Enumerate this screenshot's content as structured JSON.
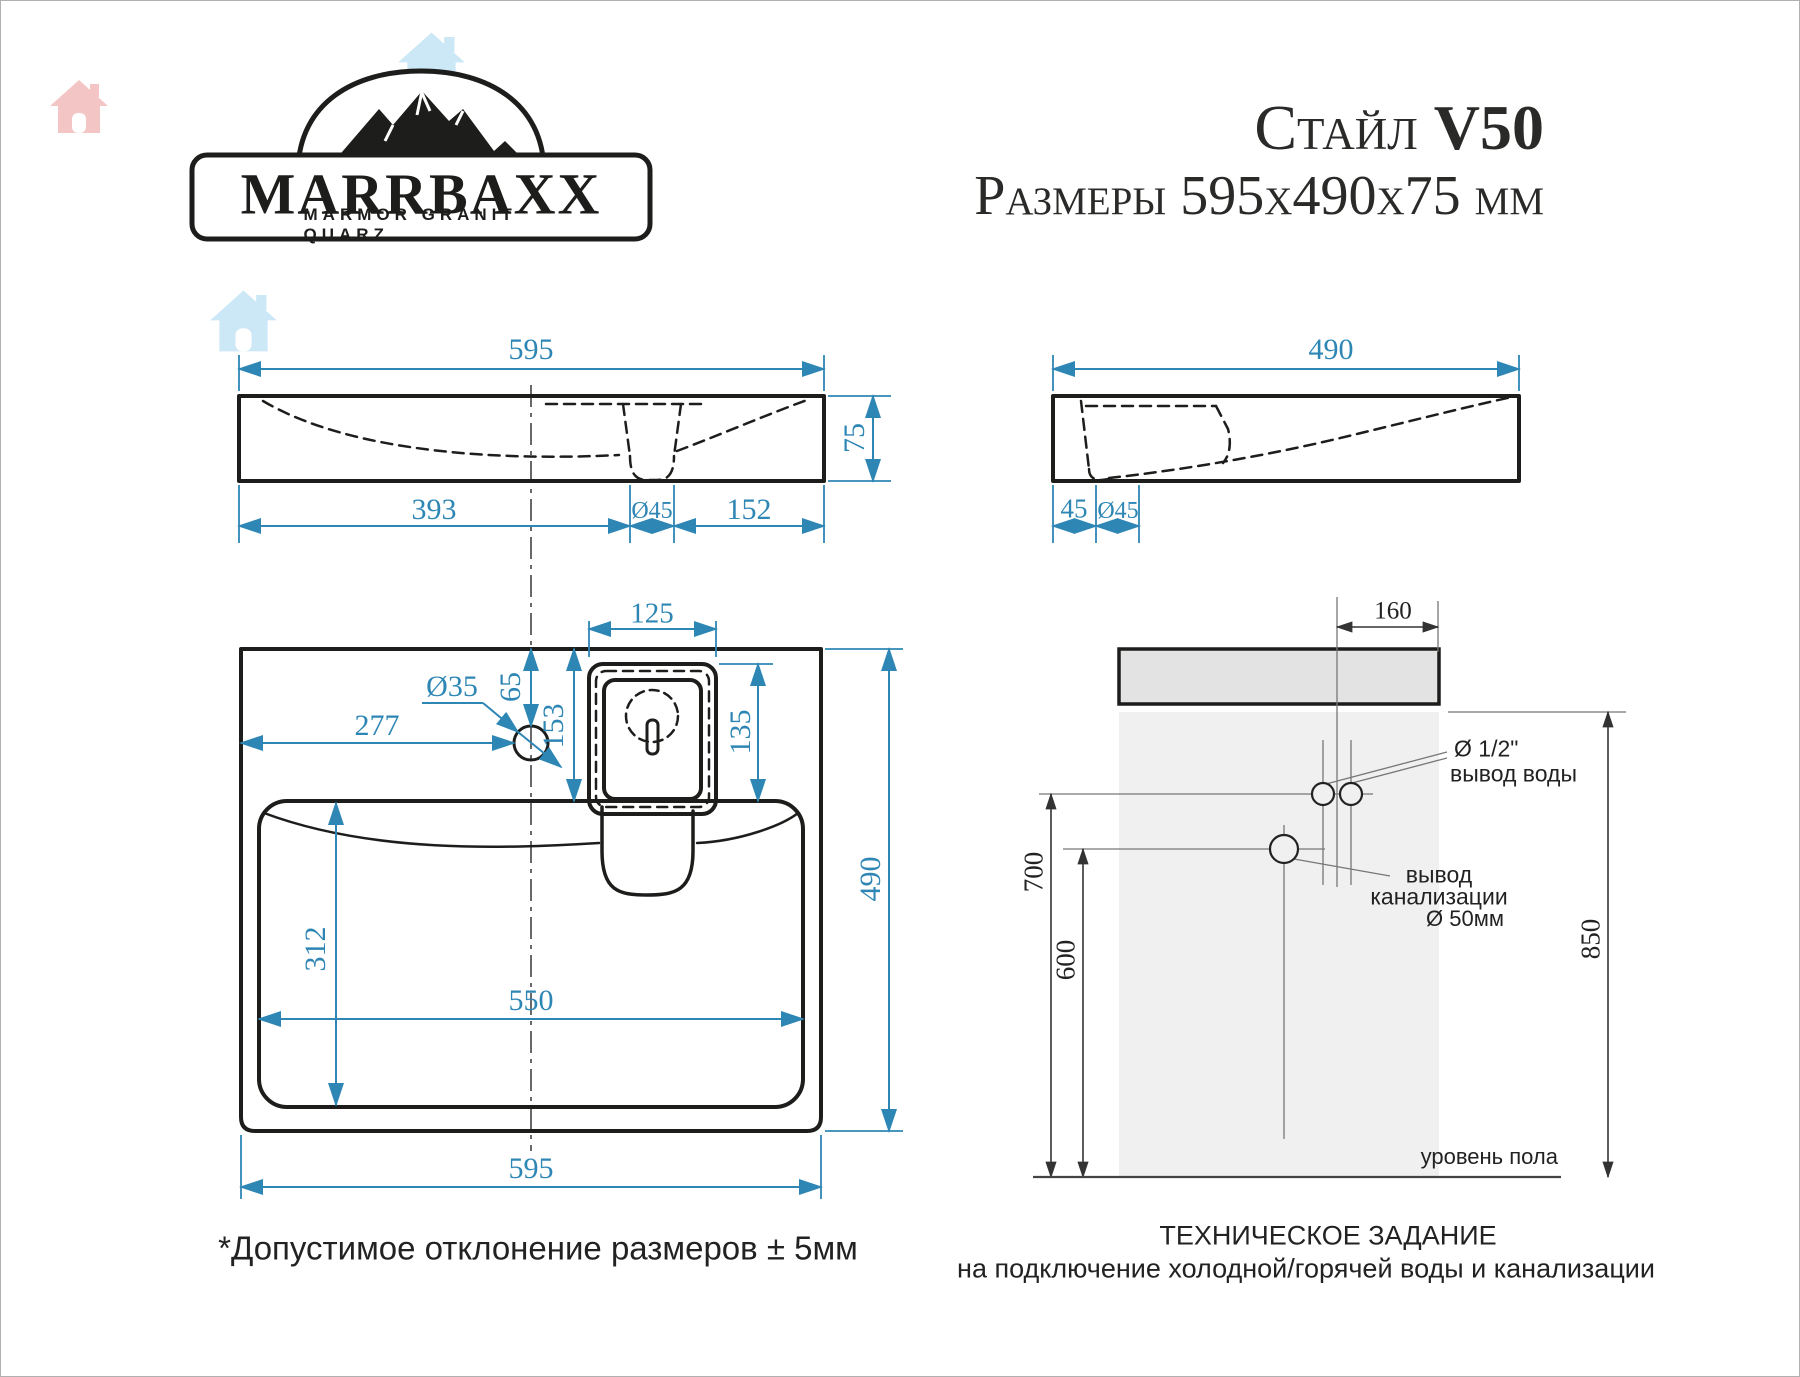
{
  "logo": {
    "brand": "MARRBAXX",
    "tagline": "MARMOR GRANIT QUARZ"
  },
  "title": {
    "model": "Стайл",
    "code": "V50",
    "dimensions": "Размеры 595x490x75 мм"
  },
  "front_view": {
    "width": "595",
    "height": "75",
    "left_to_drain": "393",
    "drain_dia": "Ø45",
    "drain_to_right": "152"
  },
  "side_view": {
    "depth": "490",
    "front_offset": "45",
    "drain_dia": "Ø45"
  },
  "top_view": {
    "overflow_width": "125",
    "faucet_offset": "65",
    "overflow_offset": "153",
    "overflow_height": "135",
    "faucet_dia": "Ø35",
    "faucet_from_left": "277",
    "bowl_front_depth": "312",
    "bowl_width": "550",
    "total_width": "595",
    "total_depth": "490"
  },
  "installation": {
    "faucet_offset": "160",
    "water_height": "700",
    "drain_height": "600",
    "top_height": "850",
    "water_dia": "Ø 1/2\"",
    "water_label": "вывод воды",
    "drain_line1": "вывод",
    "drain_line2": "канализации",
    "drain_line3": "Ø 50мм",
    "floor_label": "уровень пола",
    "heading": "ТЕХНИЧЕСКОЕ ЗАДАНИЕ",
    "subheading": "на подключение холодной/горячей воды и канализации"
  },
  "note": "*Допустимое отклонение размеров ± 5мм",
  "colors": {
    "dimension_blue": "#2e86b5",
    "line_black": "#1d1d1b",
    "watermark_pink": "#f3bcbc",
    "watermark_blue": "#c7e6f6"
  }
}
